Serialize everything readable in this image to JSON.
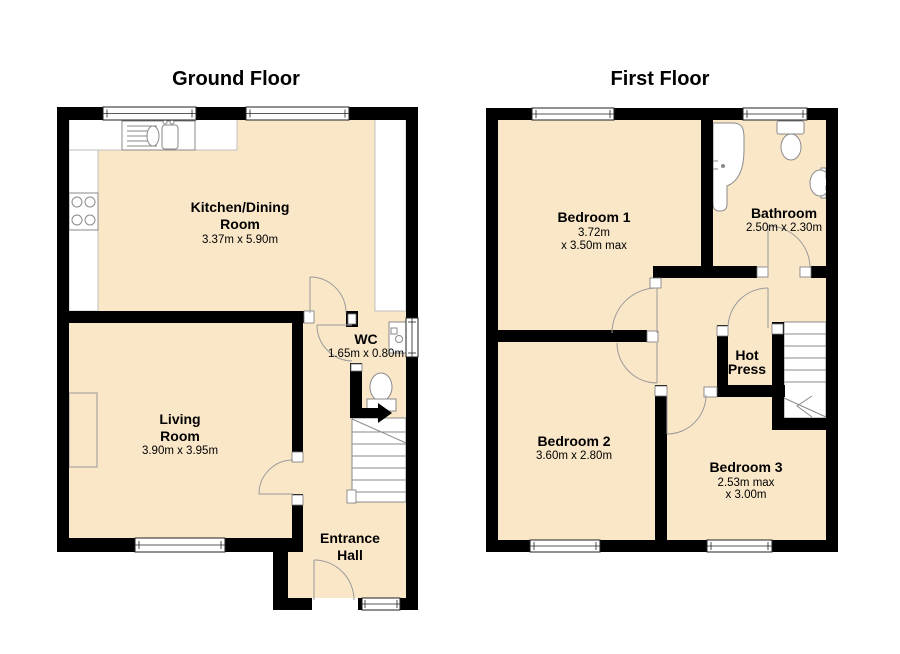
{
  "colors": {
    "floor_fill": "#FAE7C8",
    "wall": "#000000",
    "fixture_stroke": "#8a8a8a",
    "background": "#ffffff"
  },
  "ground_floor": {
    "title": "Ground Floor",
    "rooms": {
      "kitchen": {
        "line1": "Kitchen/Dining",
        "line2": "Room",
        "dims": "3.37m x 5.90m"
      },
      "living": {
        "line1": "Living",
        "line2": "Room",
        "dims": "3.90m x 3.95m"
      },
      "wc": {
        "line1": "WC",
        "dims": "1.65m x 0.80m"
      },
      "hall": {
        "line1": "Entrance",
        "line2": "Hall"
      }
    }
  },
  "first_floor": {
    "title": "First Floor",
    "rooms": {
      "bedroom1": {
        "line1": "Bedroom 1",
        "dims1": "3.72m",
        "dims2": "x 3.50m max"
      },
      "bathroom": {
        "line1": "Bathroom",
        "dims": "2.50m x 2.30m"
      },
      "bedroom2": {
        "line1": "Bedroom 2",
        "dims": "3.60m x 2.80m"
      },
      "bedroom3": {
        "line1": "Bedroom 3",
        "dims1": "2.53m max",
        "dims2": "x 3.00m"
      },
      "hot_press": {
        "line1": "Hot",
        "line2": "Press"
      }
    }
  }
}
